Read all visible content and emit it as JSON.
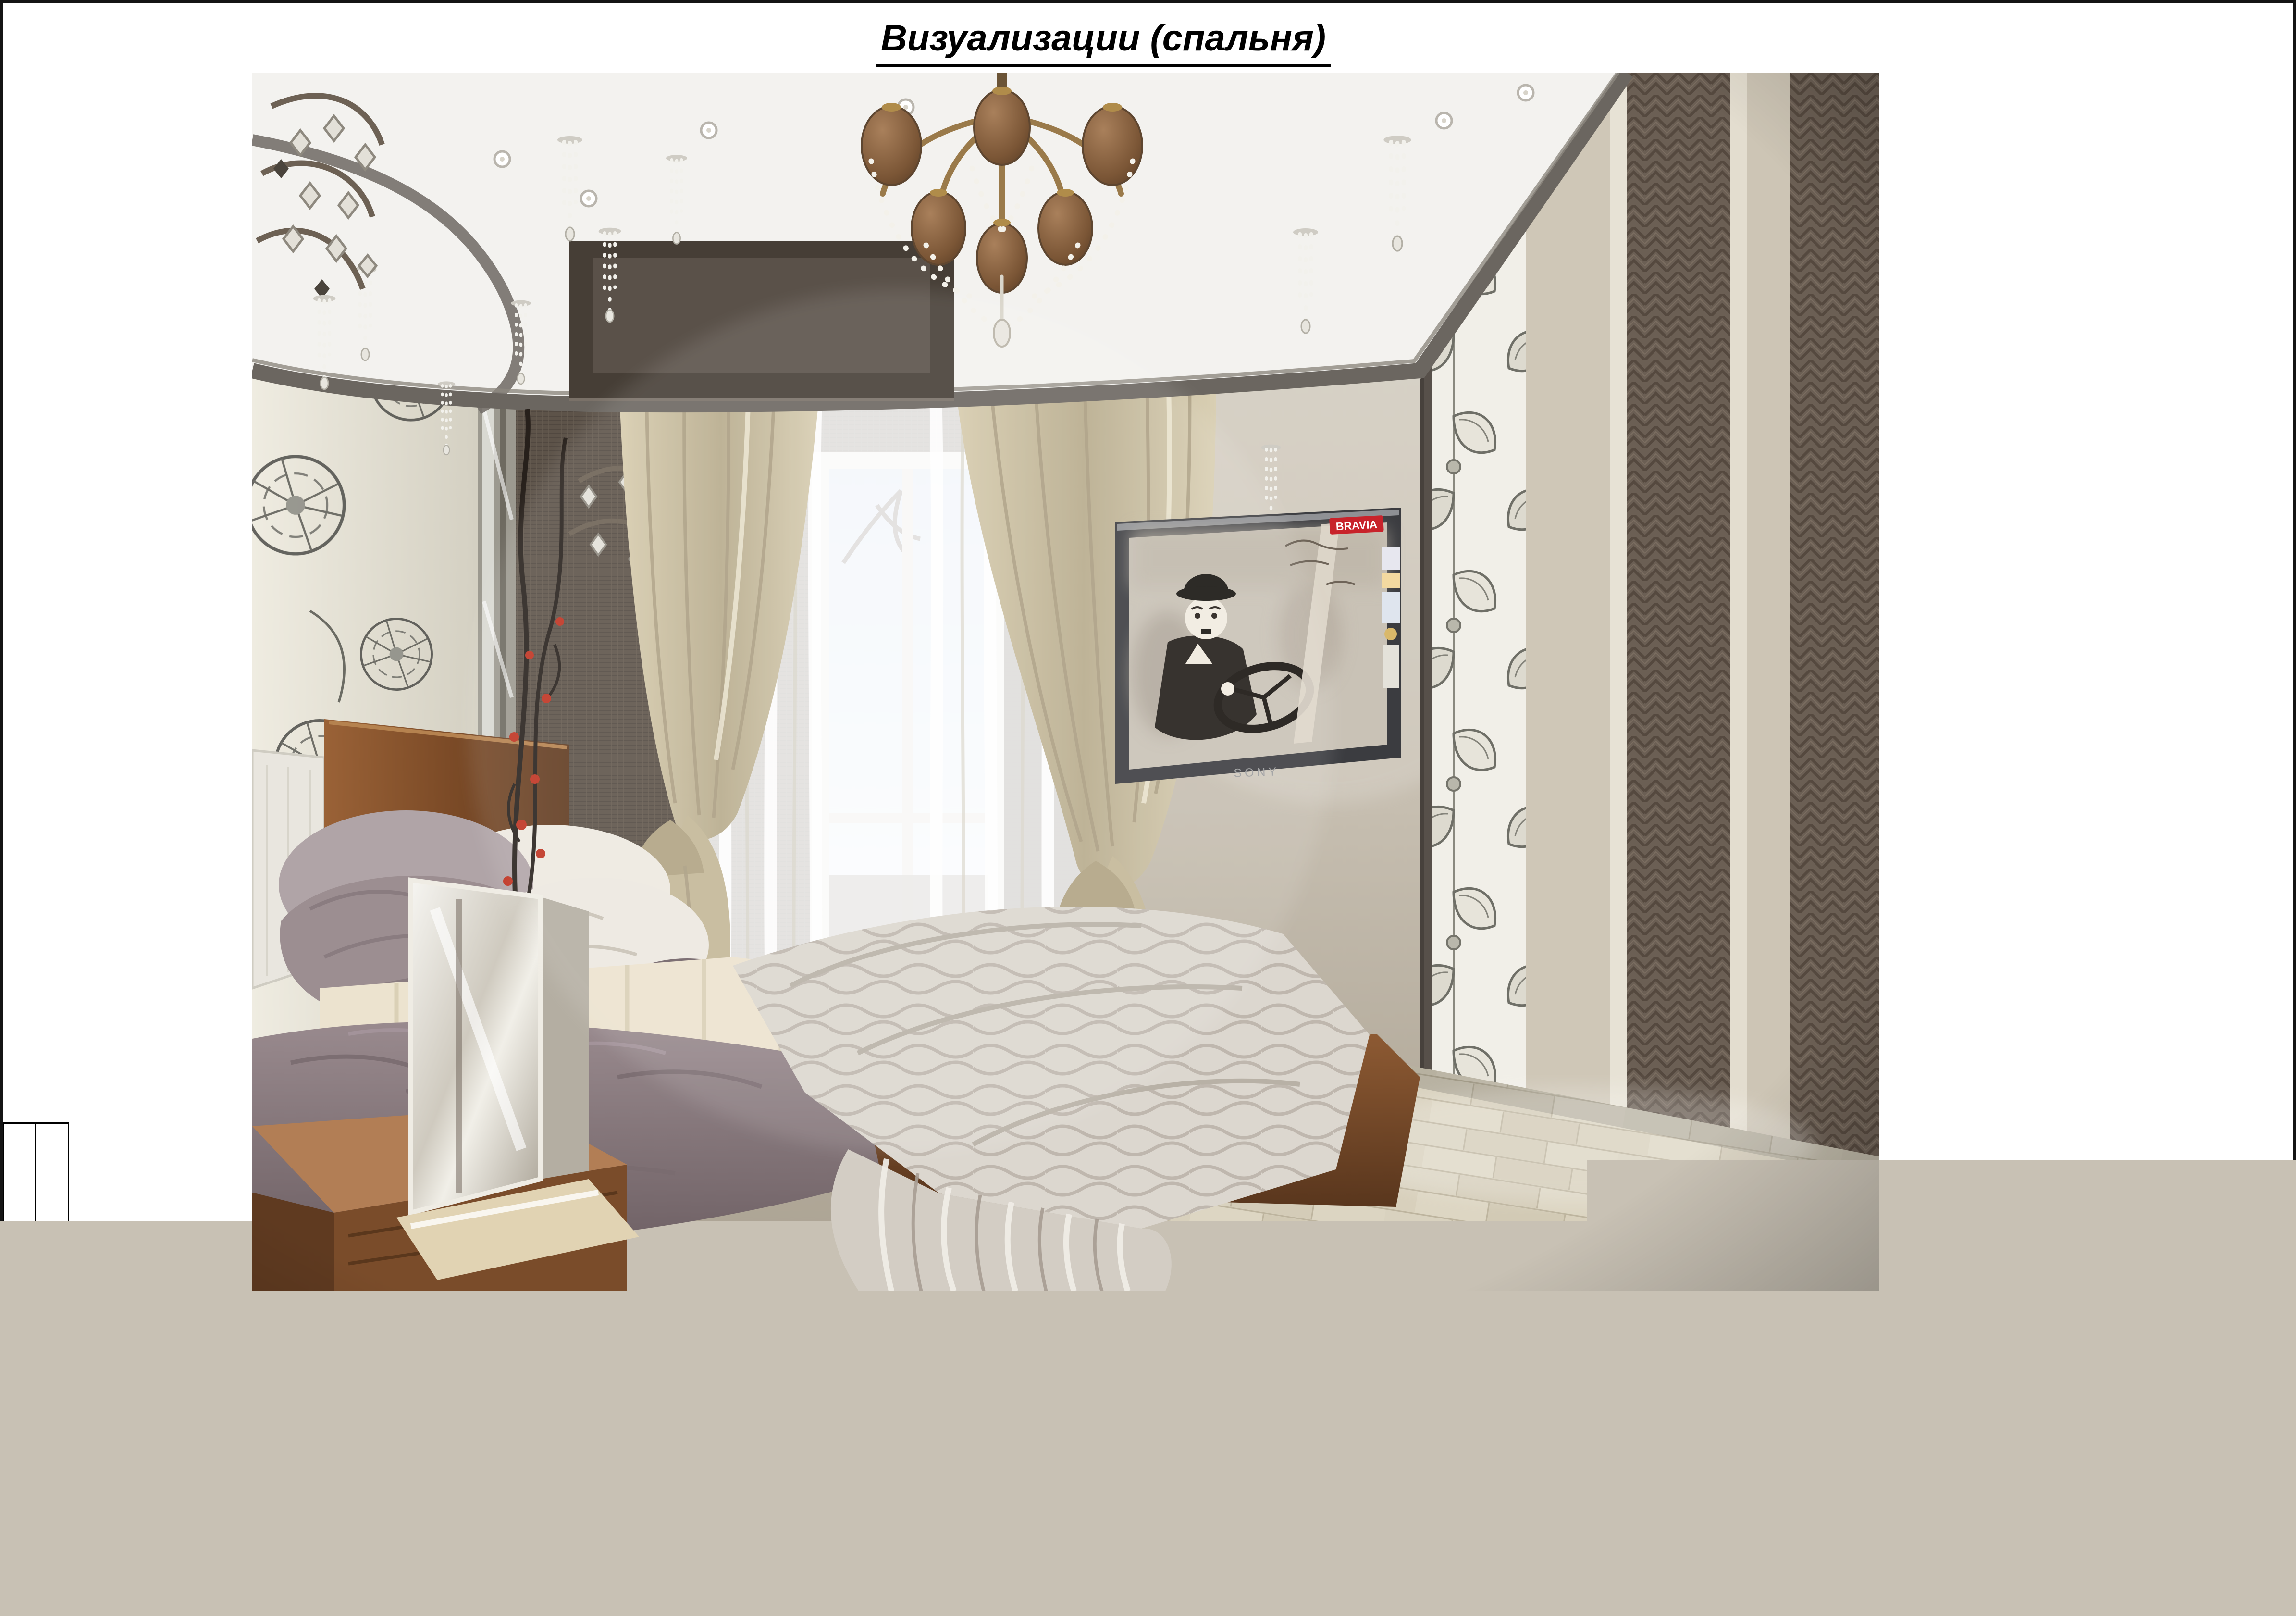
{
  "page": {
    "sheet_title": "Визуализации (спальня)",
    "frame_color": "#141414",
    "background": "#ffffff"
  },
  "side_strip": {
    "labels": [
      "Подпись и дата",
      "Изм. № пол."
    ]
  },
  "title_block": {
    "doc_code": "12.09.2011   ДП",
    "doc_type": "ДИЗАЙН- ПРОЕКТ",
    "revision_columns": [
      "Изм.",
      "Кол.уч",
      "Лист",
      "№док",
      "Подпись",
      "Дата"
    ],
    "signature_rows": [
      {
        "role": "Дизайнер",
        "name": "Лемента Д.",
        "signature": "",
        "date": "07.12"
      },
      {
        "role": "Проверил",
        "name": "Радаев А.",
        "signature": "",
        "date": "07.12"
      }
    ],
    "stage_table": {
      "headers": [
        "Стадия",
        "Лист",
        "Листов"
      ],
      "values": [
        "П",
        "24",
        "30"
      ]
    },
    "sheet_name": "Визуализации. Спальня",
    "studio_lines": [
      "Студия дизайна",
      "“ArtVision”"
    ]
  },
  "render": {
    "subject": "спальня — визуализация интерьера",
    "tv": {
      "badge": "BRAVIA",
      "brand": "SONY"
    },
    "palette": {
      "wall_beige": "#c8c1b4",
      "ceiling_band_grey": "#6b6660",
      "curtain_beige": "#cec2a4",
      "wood_brown": "#8a5a36",
      "bedspread_grey": "#dcd7cf",
      "blanket_mauve": "#8e7e82",
      "vase_teal": "#7fb6b6",
      "tv_badge_red": "#c8232b",
      "floor_parquet": "#d9d2bf"
    }
  }
}
